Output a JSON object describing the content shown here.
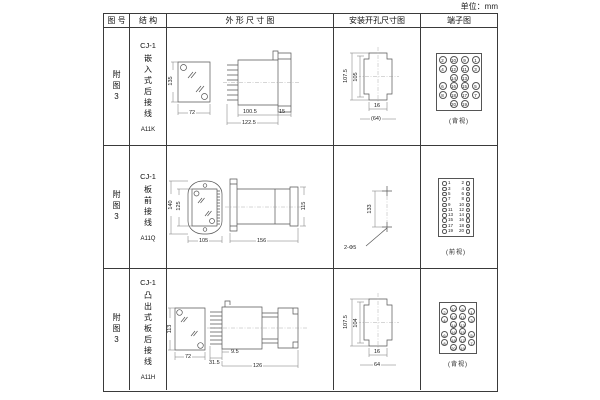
{
  "unit_label": "单位：mm",
  "table": {
    "headers": {
      "fig": "图 号",
      "struct": "结 构",
      "outline": "外 形 尺 寸 图",
      "install": "安装开孔尺寸图",
      "terminal": "端子图"
    },
    "rows": [
      {
        "fig_no": "附图3",
        "structure": {
          "model": "CJ-1",
          "desc": "嵌入式后接线",
          "code": "A11K"
        },
        "outline": {
          "front_height": "135",
          "front_width": "72",
          "body_depth": "100.5",
          "total_depth": "122.5",
          "flange_depth": "15"
        },
        "install": {
          "outer_height": "107.5",
          "inner_height": "105",
          "slot_width": "16",
          "hole_span": "(64)"
        },
        "terminal": {
          "caption": "(背视)",
          "grid": [
            [
              "2",
              "10",
              "9",
              "1"
            ],
            [
              "4",
              "12",
              "11",
              "3"
            ],
            [
              "",
              "14",
              "13",
              ""
            ],
            [
              "6",
              "16",
              "15",
              "5"
            ],
            [
              "8",
              "18",
              "17",
              "7"
            ],
            [
              "",
              "20",
              "19",
              ""
            ]
          ]
        }
      },
      {
        "fig_no": "附图3",
        "structure": {
          "model": "CJ-1",
          "desc": "板前接线",
          "code": "A11Q"
        },
        "outline": {
          "outer_height": "140",
          "inner_height": "125",
          "front_width": "105",
          "total_depth": "156",
          "side_height": "115"
        },
        "install": {
          "hole_spacing": "133",
          "hole_label": "2-Φ5"
        },
        "terminal": {
          "caption": "(前视)",
          "left_column": [
            "1",
            "3",
            "5",
            "7",
            "9",
            "11",
            "13",
            "15",
            "17",
            "19"
          ],
          "right_column": [
            "2",
            "4",
            "6",
            "8",
            "10",
            "12",
            "14",
            "16",
            "18",
            "20"
          ]
        }
      },
      {
        "fig_no": "附图3",
        "structure": {
          "model": "CJ-1",
          "desc": "凸出式板后接线",
          "code": "A11H"
        },
        "outline": {
          "front_height": "113",
          "front_width": "72",
          "pin_depth": "31.5",
          "base_offset": "9.5",
          "total_depth": "126"
        },
        "install": {
          "outer_height": "107.5",
          "inner_height": "104",
          "slot_width": "16",
          "hole_span": "64"
        },
        "terminal": {
          "caption": "(背视)",
          "grid": [
            [
              "2",
              "10",
              "9",
              "1"
            ],
            [
              "4",
              "12",
              "11",
              "3"
            ],
            [
              "",
              "14",
              "13",
              ""
            ],
            [
              "6",
              "16",
              "15",
              "5"
            ],
            [
              "8",
              "18",
              "17",
              "7"
            ],
            [
              "",
              "20",
              "19",
              ""
            ]
          ]
        }
      }
    ]
  }
}
